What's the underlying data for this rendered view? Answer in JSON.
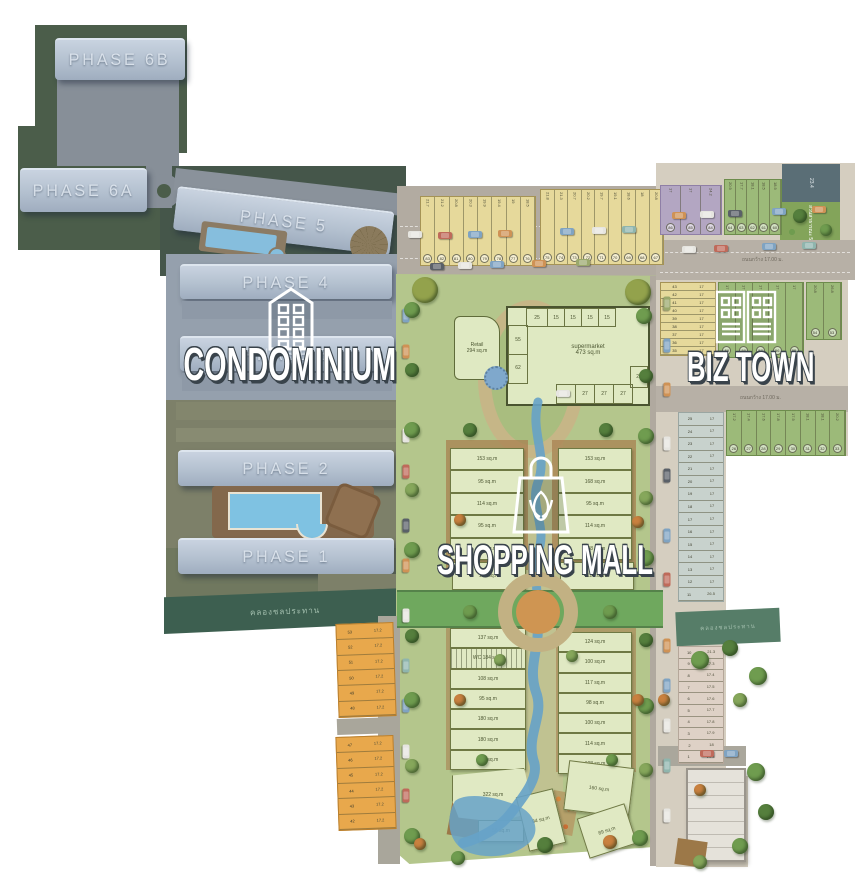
{
  "palette": {
    "cars": [
      "#e6e5e0",
      "#bf6a5a",
      "#7fa3c2",
      "#cf9255",
      "#5a6068",
      "#8fb5ad",
      "#9aa86c"
    ],
    "trees": [
      "#6f9c4f",
      "#557f3d",
      "#86a75b",
      "#93a24c",
      "#c9813f"
    ],
    "accent_condo": "#b3c0cf",
    "accent_mall": "#b4c68c",
    "accent_biz": "#d5cec0"
  },
  "condo": {
    "label": "CONDOMINIUM",
    "canal_label": "คลองชลประทาน",
    "phases": {
      "p6b": "PHASE 6B",
      "p6a": "PHASE 6A",
      "p5": "PHASE 5",
      "p4": "PHASE 4",
      "p3": "PHASE 3",
      "p2": "PHASE 2",
      "p1": "PHASE 1"
    }
  },
  "mall": {
    "label": "SHOPPING MALL",
    "retail": {
      "name": "Retail",
      "area": "294 sq.m"
    },
    "supermarket": {
      "name": "supermarket",
      "area": "473 sq.m",
      "cells_top": [
        "25",
        "15",
        "15",
        "15",
        "15"
      ],
      "cells_left": [
        "55",
        "62"
      ],
      "cells_right": [
        "29"
      ],
      "cells_bottom": [
        "25",
        "27",
        "27",
        "27"
      ]
    },
    "shops_upper_left": [
      "153 sq.m",
      "95 sq.m",
      "114 sq.m",
      "95 sq.m",
      "114 sq.m"
    ],
    "shop_ul6": "108 sq.m",
    "shops_upper_right": [
      "153 sq.m",
      "168 sq.m",
      "95 sq.m",
      "114 sq.m",
      "108 sq.m"
    ],
    "shop_ur6": "124 sq.m",
    "shops_lower_left": [
      "137 sq.m",
      "WC 184 sq.m",
      "108 sq.m",
      "95 sq.m",
      "180 sq.m",
      "180 sq.m",
      "122 sq.m"
    ],
    "shops_lower_right": [
      "124 sq.m",
      "100 sq.m",
      "117 sq.m",
      "98 sq.m",
      "100 sq.m",
      "114 sq.m",
      "108 sq.m"
    ],
    "shops_bottom": [
      "322 sq.m",
      "58 sq.m",
      "84 sq.m",
      "160 sq.m",
      "89 sq.m"
    ]
  },
  "biz": {
    "label": "BIZ TOWN",
    "road_label": "ถนนกว้าง 17.00 ม.",
    "canal_label": "คลองชลประทาน",
    "park_label": "สวนสาธารณะ 554.1",
    "club_label": "23.4",
    "strips": {
      "row_top_a": {
        "cells": [
          {
            "n": "83",
            "w": "21.7"
          },
          {
            "n": "82",
            "w": "21.2"
          },
          {
            "n": "81",
            "w": "20.8"
          },
          {
            "n": "80",
            "w": "20.3"
          },
          {
            "n": "79",
            "w": "19.9"
          },
          {
            "n": "78",
            "w": "19.4"
          },
          {
            "n": "77",
            "w": "19"
          },
          {
            "n": "76",
            "w": "18.5"
          }
        ]
      },
      "row_top_b": {
        "cells": [
          {
            "n": "75",
            "w": "21.8"
          },
          {
            "n": "74",
            "w": "21.3"
          },
          {
            "n": "73",
            "w": "20.7"
          },
          {
            "n": "72",
            "w": "20.2"
          },
          {
            "n": "71",
            "w": "19.7"
          },
          {
            "n": "70",
            "w": "19.1"
          },
          {
            "n": "69",
            "w": "18.6"
          },
          {
            "n": "68",
            "w": "18"
          },
          {
            "n": "67",
            "w": "20.8"
          }
        ]
      },
      "purple": {
        "cells": [
          {
            "n": "86",
            "w": "17"
          },
          {
            "n": "85",
            "w": "17"
          },
          {
            "n": "84",
            "w": "24.2"
          }
        ]
      },
      "green_ne": {
        "cells": [
          {
            "n": "64",
            "w": "20.9"
          },
          {
            "n": "63",
            "w": "17.7"
          },
          {
            "n": "62",
            "w": "18.1"
          },
          {
            "n": "61",
            "w": "18.5"
          },
          {
            "n": "60",
            "w": "18.9"
          }
        ]
      },
      "yellow_col": {
        "cells": [
          {
            "n": "43",
            "w": "17"
          },
          {
            "n": "42",
            "w": "17"
          },
          {
            "n": "41",
            "w": "17"
          },
          {
            "n": "40",
            "w": "17"
          },
          {
            "n": "39",
            "w": "17"
          },
          {
            "n": "38",
            "w": "17"
          },
          {
            "n": "37",
            "w": "17"
          },
          {
            "n": "36",
            "w": "17"
          },
          {
            "n": "35",
            "w": "17"
          }
        ]
      },
      "green_mid": {
        "cells": [
          {
            "n": "59",
            "w": "17"
          },
          {
            "n": "58",
            "w": "17"
          },
          {
            "n": "57",
            "w": "17"
          },
          {
            "n": "56",
            "w": "17"
          },
          {
            "n": "55",
            "w": "17"
          }
        ]
      },
      "green_mid2": {
        "cells": [
          {
            "n": "54",
            "w": "20.8"
          },
          {
            "n": "53",
            "w": "26.8"
          }
        ]
      },
      "green_row3": {
        "cells": [
          {
            "n": "26",
            "w": "17.2"
          },
          {
            "n": "27",
            "w": "17.4"
          },
          {
            "n": "28",
            "w": "17.6"
          },
          {
            "n": "29",
            "w": "17.8"
          },
          {
            "n": "30",
            "w": "17.9"
          },
          {
            "n": "31",
            "w": "18.1"
          },
          {
            "n": "32",
            "w": "18.1"
          },
          {
            "n": "33",
            "w": "20.2"
          }
        ]
      },
      "vert_col": {
        "cells": [
          {
            "n": "25",
            "w": "17"
          },
          {
            "n": "24",
            "w": "17"
          },
          {
            "n": "23",
            "w": "17"
          },
          {
            "n": "22",
            "w": "17"
          },
          {
            "n": "21",
            "w": "17"
          },
          {
            "n": "20",
            "w": "17"
          },
          {
            "n": "19",
            "w": "17"
          },
          {
            "n": "18",
            "w": "17"
          },
          {
            "n": "17",
            "w": "17"
          },
          {
            "n": "16",
            "w": "17"
          },
          {
            "n": "15",
            "w": "17"
          },
          {
            "n": "14",
            "w": "17"
          },
          {
            "n": "13",
            "w": "17"
          },
          {
            "n": "12",
            "w": "17"
          },
          {
            "n": "11",
            "w": "26.5"
          }
        ]
      },
      "pink_col": {
        "cells": [
          {
            "n": "10",
            "w": "21.3"
          },
          {
            "n": "9",
            "w": "17.3"
          },
          {
            "n": "8",
            "w": "17.4"
          },
          {
            "n": "7",
            "w": "17.5"
          },
          {
            "n": "6",
            "w": "17.6"
          },
          {
            "n": "5",
            "w": "17.7"
          },
          {
            "n": "4",
            "w": "17.8"
          },
          {
            "n": "3",
            "w": "17.9"
          },
          {
            "n": "2",
            "w": "18"
          },
          {
            "n": "1",
            "w": "21.3"
          }
        ]
      },
      "orange_a": {
        "cells": [
          {
            "n": "53",
            "w": "17.2"
          },
          {
            "n": "52",
            "w": "17.2"
          },
          {
            "n": "51",
            "w": "17.2"
          },
          {
            "n": "50",
            "w": "17.2"
          },
          {
            "n": "49",
            "w": "17.2"
          },
          {
            "n": "48",
            "w": "17.2"
          }
        ]
      },
      "orange_b": {
        "cells": [
          {
            "n": "47",
            "w": "17.2"
          },
          {
            "n": "46",
            "w": "17.2"
          },
          {
            "n": "45",
            "w": "17.2"
          },
          {
            "n": "44",
            "w": "17.2"
          },
          {
            "n": "43",
            "w": "17.2"
          },
          {
            "n": "42",
            "w": "17.2"
          }
        ]
      }
    }
  }
}
